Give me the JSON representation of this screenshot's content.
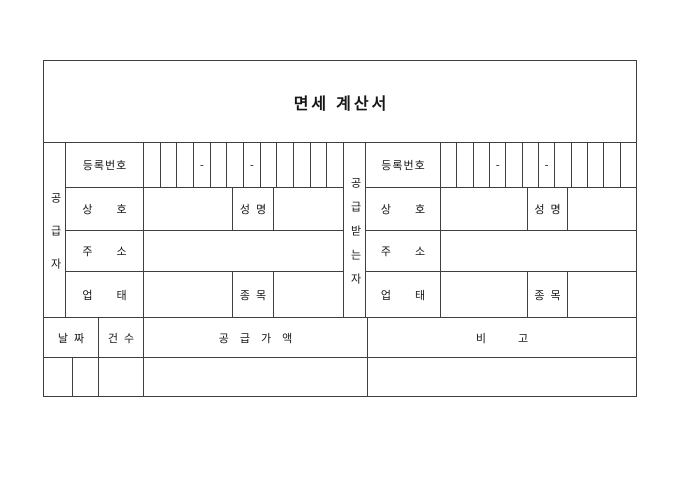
{
  "title": "면세 계산서",
  "labels": {
    "reg_number": "등록번호",
    "trade_name": "상호",
    "name": "성명",
    "address": "주소",
    "business_type": "업태",
    "item": "종목"
  },
  "supplier": {
    "side_label": "공급자"
  },
  "recipient": {
    "side_label": "공급받는자"
  },
  "reg_number_cells": {
    "count": 12,
    "dash_positions": [
      4,
      7
    ],
    "dash": "-"
  },
  "summary": {
    "date": "날짜",
    "count": "건수",
    "supply_value": "공급가액",
    "remarks": "비고"
  },
  "colors": {
    "line": "#3f3f3f",
    "background": "#ffffff",
    "text": "#161616"
  }
}
